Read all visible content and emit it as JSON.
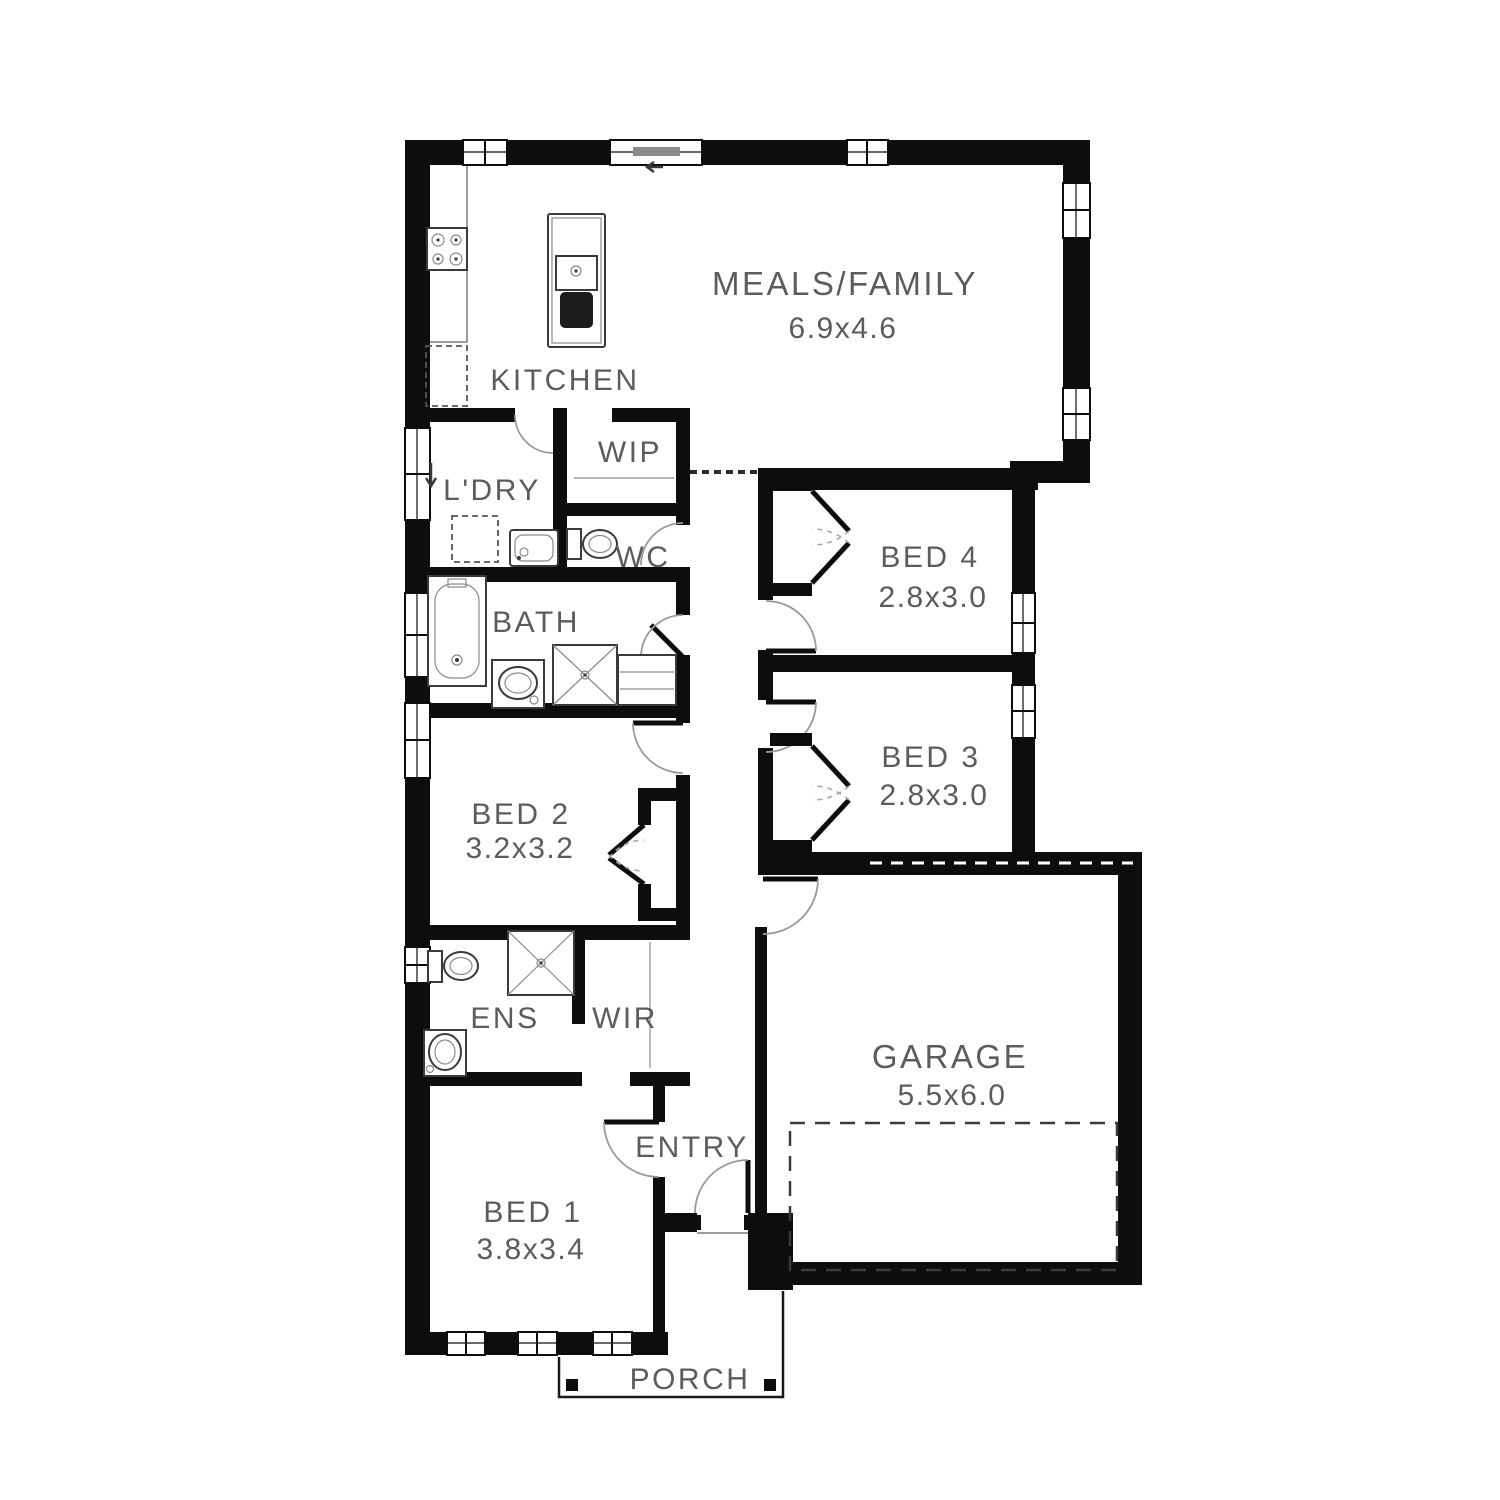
{
  "plan": {
    "title": "House floor plan",
    "colors": {
      "background": "#ffffff",
      "wall": "#0d0d0d",
      "label": "#5c5c5c",
      "fixture": "#3a3a3a",
      "door_arc": "#9a9a9a"
    },
    "rooms": {
      "meals_family": {
        "label": "MEALS/FAMILY",
        "dims": "6.9x4.6"
      },
      "kitchen": {
        "label": "KITCHEN"
      },
      "wip": {
        "label": "WIP"
      },
      "ldry": {
        "label": "L'DRY"
      },
      "wc": {
        "label": "WC"
      },
      "bath": {
        "label": "BATH"
      },
      "bed4": {
        "label": "BED 4",
        "dims": "2.8x3.0"
      },
      "bed3": {
        "label": "BED 3",
        "dims": "2.8x3.0"
      },
      "bed2": {
        "label": "BED 2",
        "dims": "3.2x3.2"
      },
      "ens": {
        "label": "ENS"
      },
      "wir": {
        "label": "WIR"
      },
      "garage": {
        "label": "GARAGE",
        "dims": "5.5x6.0"
      },
      "entry": {
        "label": "ENTRY"
      },
      "bed1": {
        "label": "BED 1",
        "dims": "3.8x3.4"
      },
      "porch": {
        "label": "PORCH"
      }
    }
  }
}
